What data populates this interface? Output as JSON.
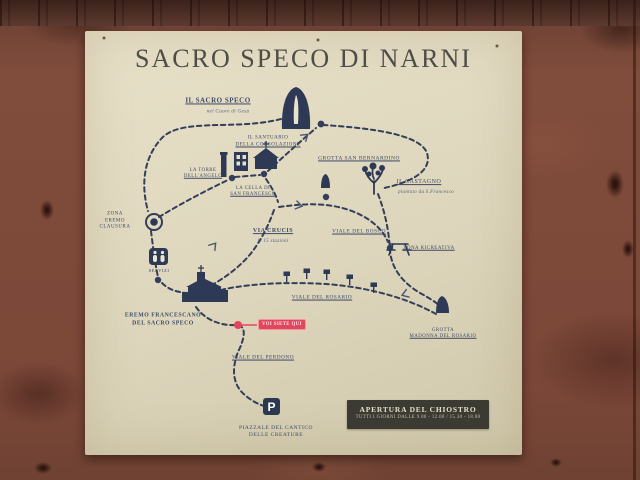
{
  "sign": {
    "title": "SACRO SPECO DI NARNI",
    "labels": {
      "sacro_speco": {
        "name": "IL SACRO SPECO",
        "subtitle": "nel Cuore di Gesù"
      },
      "santuario": {
        "line1": "IL SANTUARIO",
        "line2": "DELLA CONSOLAZIONE"
      },
      "grotta_san_bernardino": {
        "name": "GROTTA SAN BERNARDINO"
      },
      "torre": {
        "line1": "LA TORRE",
        "line2": "DELL'ANGELO"
      },
      "cella": {
        "line1": "LA CELLA DI",
        "line2": "SAN FRANCESCO"
      },
      "castagno": {
        "name": "IL CASTAGNO",
        "subtitle": "piantato da S.Francesco"
      },
      "zona_eremo": {
        "line1": "ZONA",
        "line2": "EREMO",
        "line3": "CLAUSURA"
      },
      "via_crucis": {
        "name": "VIA CRUCIS",
        "subtitle": "le 15 stazioni"
      },
      "viale_bosco": {
        "name": "VIALE DEL BOSCO"
      },
      "zona_ricreativa": {
        "name": "ZONA RICREATIVA"
      },
      "servizi": {
        "name": "SERVIZI"
      },
      "eremo": {
        "line1": "EREMO FRANCESCANO",
        "line2": "DEL SACRO SPECO"
      },
      "viale_rosario": {
        "name": "VIALE DEL ROSARIO"
      },
      "grotta_rosario": {
        "line1": "GROTTA",
        "line2": "MADONNA DEL ROSARIO"
      },
      "viale_perdono": {
        "name": "VIALE DEL PERDONO"
      },
      "piazzale": {
        "line1": "PIAZZALE DEL CANTICO",
        "line2": "DELLE CREATURE"
      }
    },
    "marker": {
      "you_are_here": "VOI SIETE QUI"
    },
    "parking_symbol": "P",
    "info_box": {
      "title": "APERTURA DEL CHIOSTRO",
      "hours": "TUTTI I GIORNI DALLE 9.00 - 12.00 / 15.30 - 18.00"
    },
    "colors": {
      "sign_background": "#ddd6bc",
      "label_ink": "#3e4965",
      "title_ink": "#4e4d47",
      "trail_ink": "#333f5a",
      "marker_red": "#e0475c",
      "info_box_background": "#3b3a33",
      "wood_board": "#7d4939",
      "parking_badge": "#2c3850"
    }
  }
}
